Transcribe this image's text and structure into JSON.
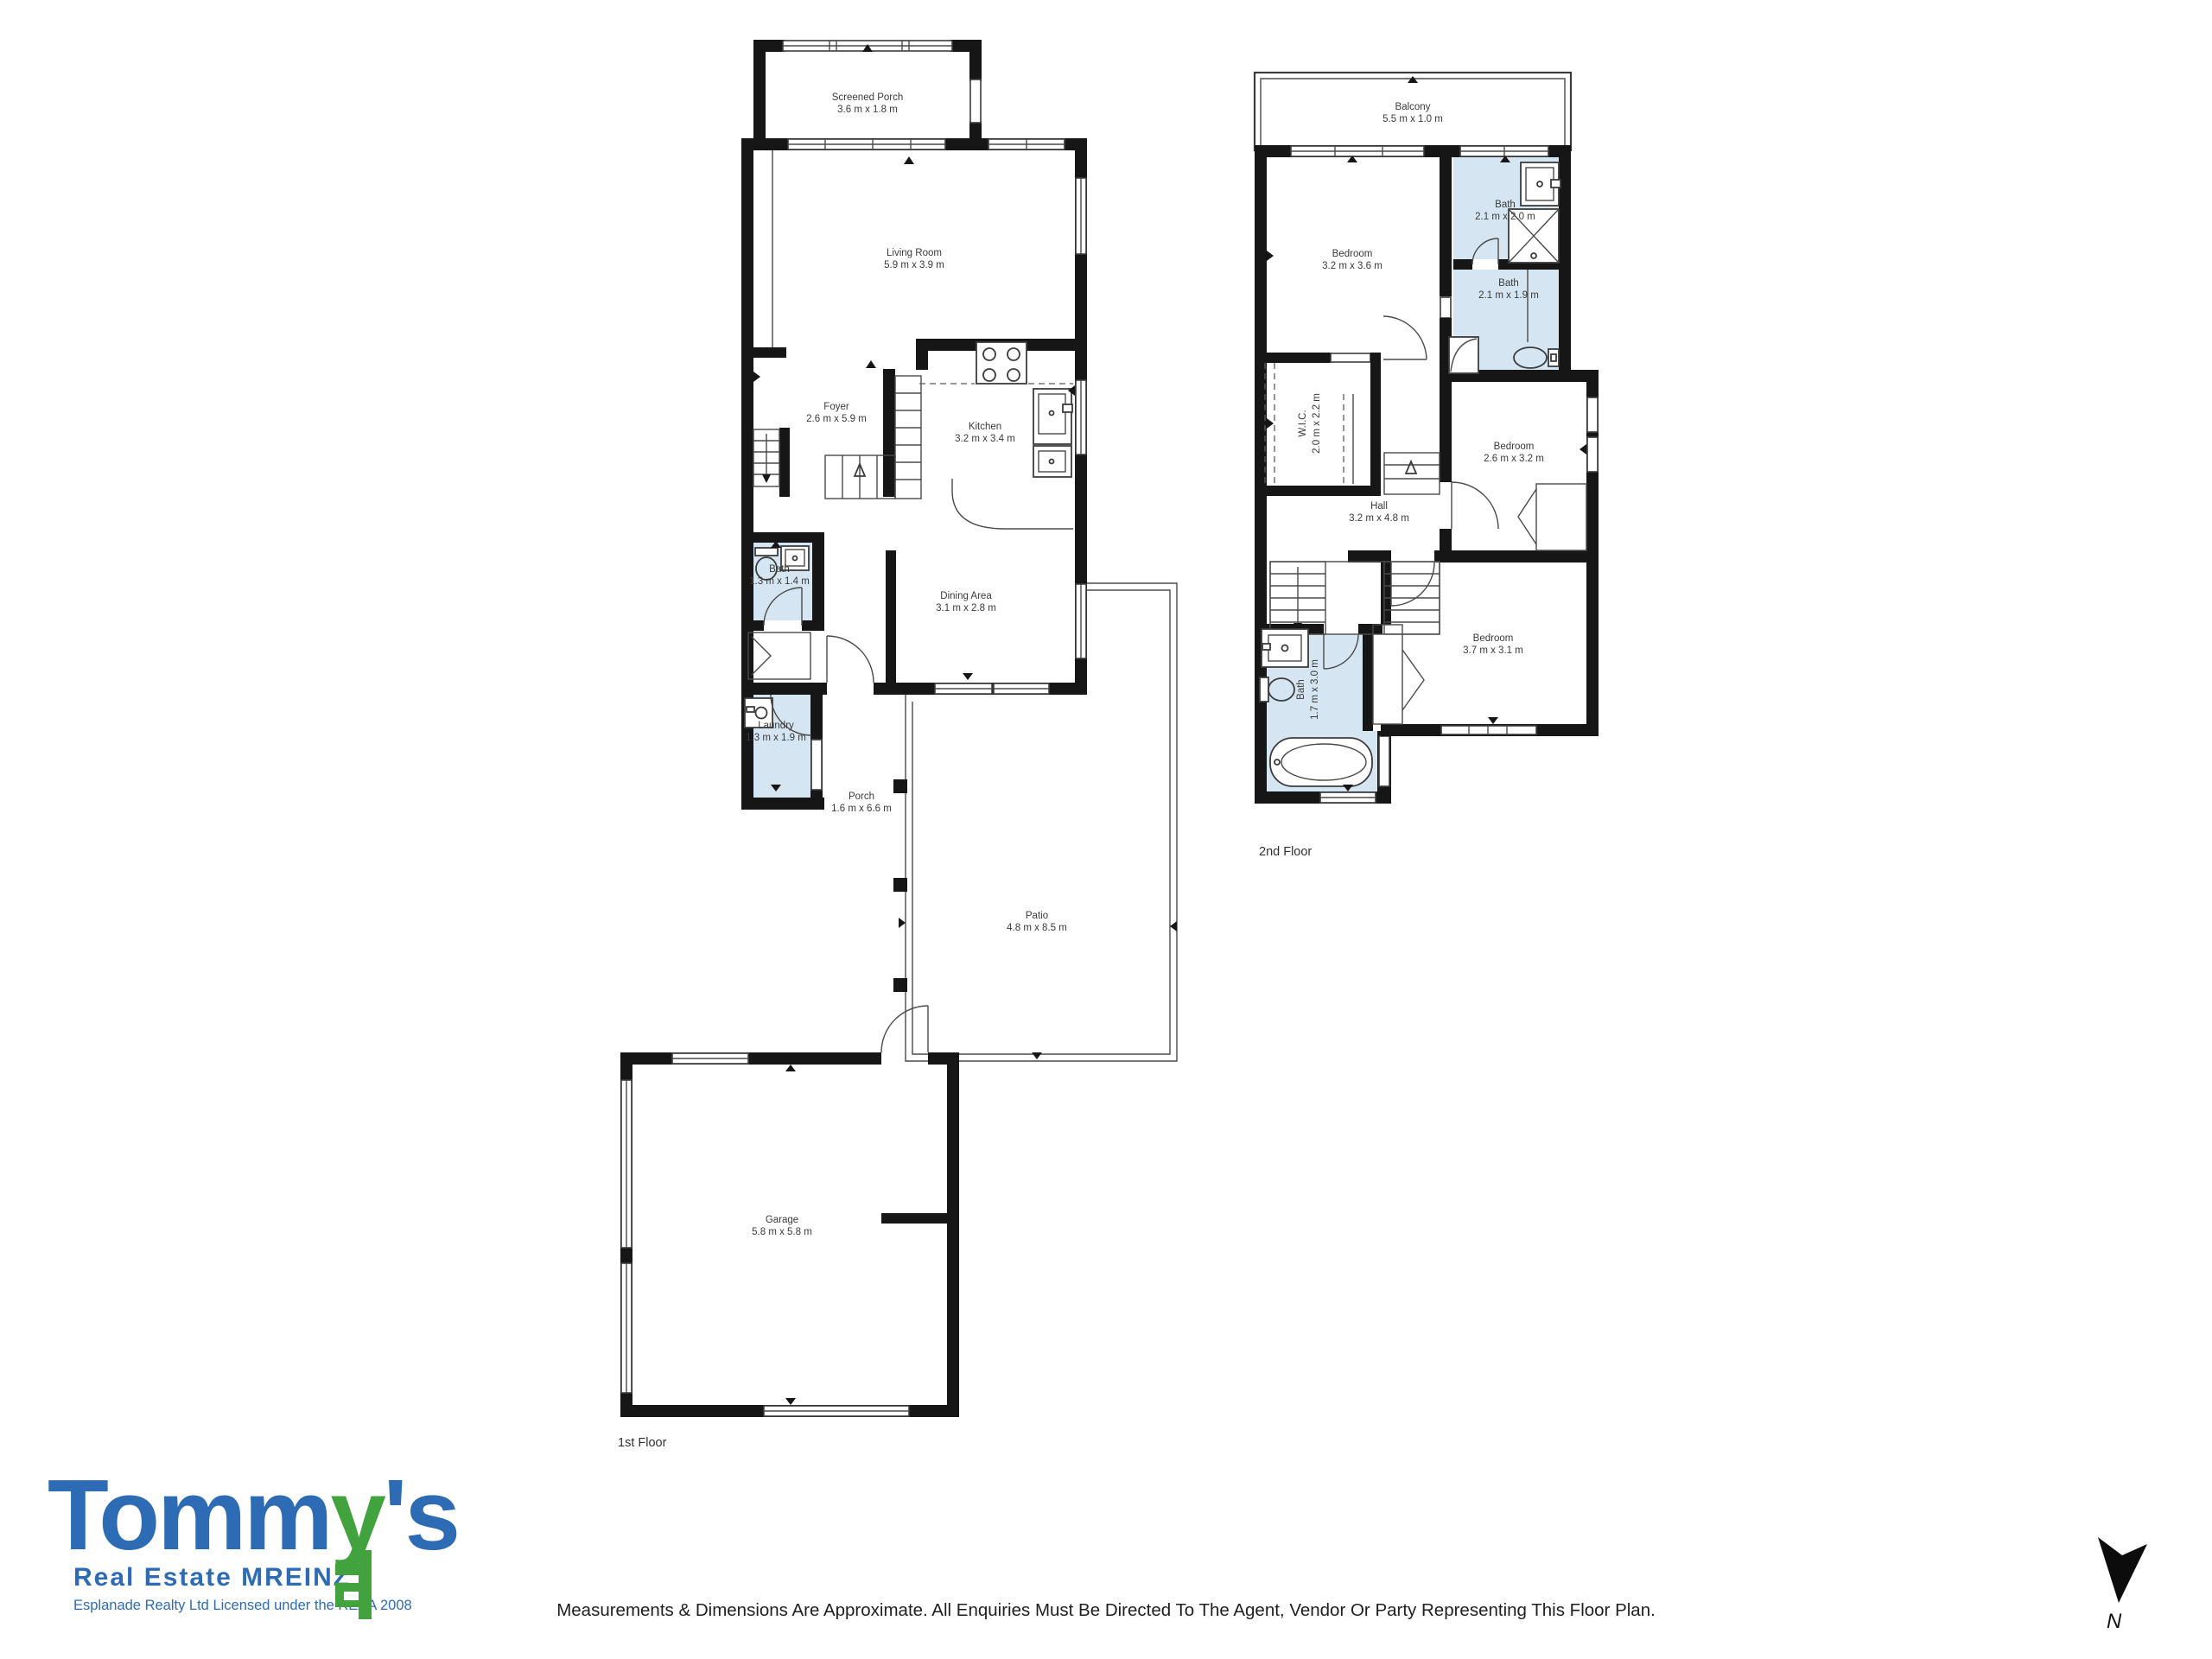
{
  "colors": {
    "wall": "#161616",
    "bath_fill": "#d5e6f2",
    "logo_blue": "#2d6cb5",
    "logo_green": "#42a33e",
    "label_text": "#3a3a3a"
  },
  "floors": [
    {
      "label": "1st Floor",
      "rooms": [
        {
          "name": "Screened Porch",
          "dims": "3.6 m x 1.8 m"
        },
        {
          "name": "Living Room",
          "dims": "5.9 m x 3.9 m"
        },
        {
          "name": "Foyer",
          "dims": "2.6 m x 5.9 m"
        },
        {
          "name": "Kitchen",
          "dims": "3.2 m x 3.4 m"
        },
        {
          "name": "Bath",
          "dims": "1.3 m x 1.4 m"
        },
        {
          "name": "Dining Area",
          "dims": "3.1 m x 2.8 m"
        },
        {
          "name": "Laundry",
          "dims": "1.3 m x 1.9 m"
        },
        {
          "name": "Porch",
          "dims": "1.6 m x 6.6 m"
        },
        {
          "name": "Patio",
          "dims": "4.8 m x 8.5 m"
        },
        {
          "name": "Garage",
          "dims": "5.8 m x 5.8 m"
        }
      ]
    },
    {
      "label": "2nd Floor",
      "rooms": [
        {
          "name": "Balcony",
          "dims": "5.5 m x 1.0 m"
        },
        {
          "name": "Bedroom",
          "dims": "3.2 m x 3.6 m"
        },
        {
          "name": "Bath",
          "dims": "2.1 m x 2.0 m"
        },
        {
          "name": "Bath",
          "dims": "2.1 m x 1.9 m"
        },
        {
          "name": "W.I.C.",
          "dims": "2.0 m x 2.2 m"
        },
        {
          "name": "Bedroom",
          "dims": "2.6 m x 3.2 m"
        },
        {
          "name": "Hall",
          "dims": "3.2 m x 4.8 m"
        },
        {
          "name": "Bath",
          "dims": "1.7 m x 3.0 m"
        },
        {
          "name": "Bedroom",
          "dims": "3.7 m x 3.1 m"
        }
      ]
    }
  ],
  "branding": {
    "logo_segments": [
      "Tomm",
      "y",
      "'s"
    ],
    "tagline": "Real Estate MREINZ",
    "license": "Esplanade Realty Ltd Licensed under the REAA 2008"
  },
  "footer": {
    "disclaimer": "Measurements & Dimensions Are Approximate. All Enquiries Must Be Directed To The Agent, Vendor Or Party Representing This Floor Plan."
  },
  "compass": {
    "label": "N"
  }
}
